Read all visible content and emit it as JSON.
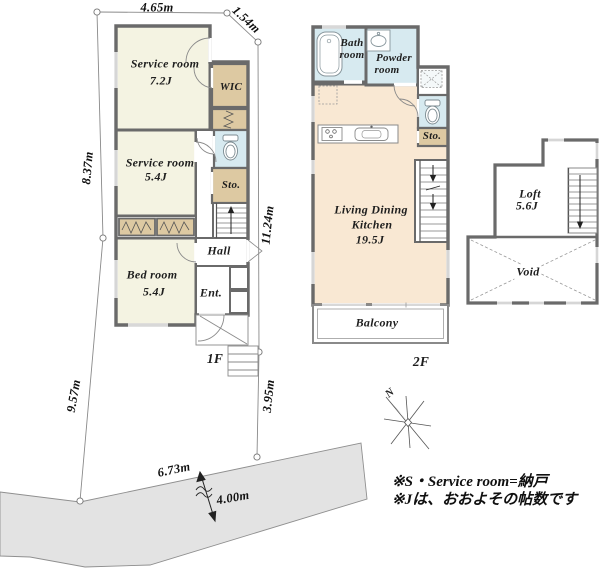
{
  "property": {
    "dimensions": {
      "top_width": "4.65m",
      "top_right_diagonal": "1.54m",
      "left_upper": "8.37m",
      "left_lower": "9.57m",
      "right_upper": "11.24m",
      "right_lower": "3.95m",
      "road_frontage": "6.73m",
      "road_width": "4.00m"
    }
  },
  "floor1": {
    "label": "1F",
    "service_room_1": {
      "name": "Service room",
      "area": "7.2J"
    },
    "service_room_2": {
      "name": "Service room",
      "area": "5.4J"
    },
    "bed_room": {
      "name": "Bed room",
      "area": "5.4J"
    },
    "wic_label": "WIC",
    "storage_label": "Sto.",
    "hall_label": "Hall",
    "entrance_label": "Ent."
  },
  "floor2": {
    "label": "2F",
    "bath_room": {
      "line1": "Bath",
      "line2": "room"
    },
    "powder_room": {
      "line1": "Powder",
      "line2": "room"
    },
    "living_dining_kitchen": {
      "line1": "Living Dining",
      "line2": "Kitchen",
      "area": "19.5J"
    },
    "storage_label": "Sto.",
    "balcony_label": "Balcony"
  },
  "loft": {
    "name": "Loft",
    "area": "5.6J",
    "void_label": "Void"
  },
  "compass": {
    "north": "N"
  },
  "notes": {
    "line1": "※S・Service room=納戸",
    "line2": "※Jは、おおよその帖数です"
  },
  "colors": {
    "wall": "#6a6a6a",
    "room_cream": "#f4f3e2",
    "closet_tan": "#ddc9a2",
    "wet_area_blue": "#d7eaf0",
    "ldk_peach": "#f9e8d3",
    "road_gray": "#e3e3e3",
    "boundary_line": "#8a8a8a"
  }
}
